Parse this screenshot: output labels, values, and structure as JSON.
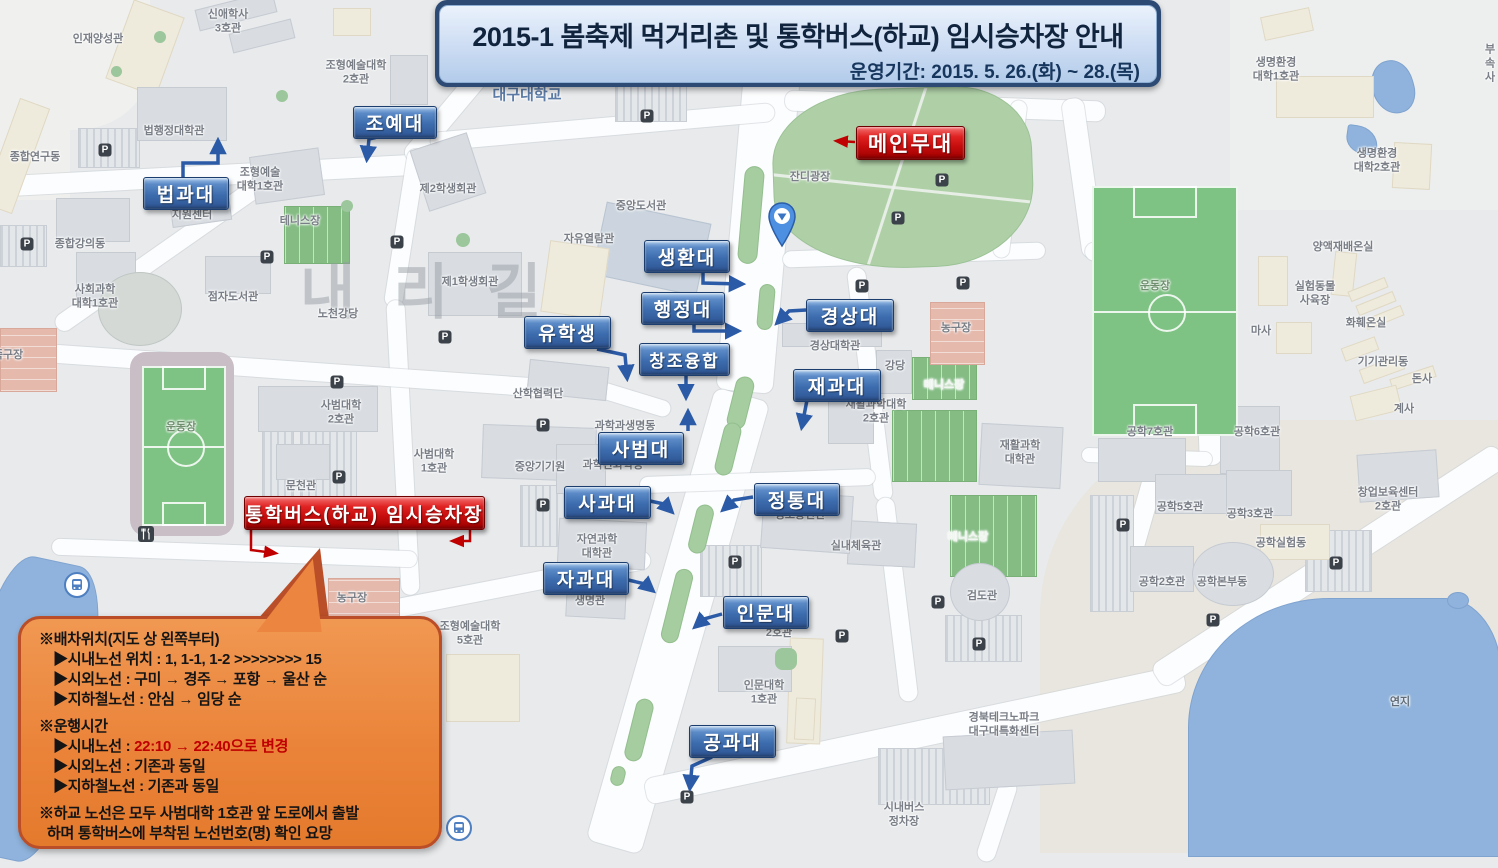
{
  "banner": {
    "title": "2015-1 봄축제 먹거리촌 및 통학버스(하교) 임시승차장 안내",
    "subtitle": "운영기간: 2015. 5. 26.(화) ~ 28.(목)"
  },
  "watermark": {
    "text": "내리길"
  },
  "icons": {
    "parking_glyph": "P"
  },
  "colors": {
    "label_blue": "#3D6CAE",
    "label_red": "#C60D0D",
    "bubble_orange": "#EA8238",
    "highlight_red": "#C00000"
  },
  "map_labels": [
    {
      "t": "인재양성관",
      "x": 98,
      "y": 40
    },
    {
      "t": "신애학사\n3호관",
      "x": 228,
      "y": 22
    },
    {
      "t": "조형예술대학\n2호관",
      "x": 356,
      "y": 73
    },
    {
      "t": "대구대학교",
      "x": 527,
      "y": 96,
      "fs": 15,
      "c": "#5C7CA8",
      "b": true
    },
    {
      "t": "법행정대학관",
      "x": 174,
      "y": 132
    },
    {
      "t": "종합연구동",
      "x": 35,
      "y": 158
    },
    {
      "t": "조형예술\n대학1호관",
      "x": 260,
      "y": 180
    },
    {
      "t": "지원센터",
      "x": 192,
      "y": 216
    },
    {
      "t": "테니스장",
      "x": 300,
      "y": 222
    },
    {
      "t": "제2학생회관",
      "x": 448,
      "y": 190
    },
    {
      "t": "중앙도서관",
      "x": 641,
      "y": 207
    },
    {
      "t": "자유열람관",
      "x": 589,
      "y": 240
    },
    {
      "t": "잔디광장",
      "x": 810,
      "y": 178
    },
    {
      "t": "제1학생회관",
      "x": 470,
      "y": 283
    },
    {
      "t": "노천강당",
      "x": 338,
      "y": 315
    },
    {
      "t": "종합강의동",
      "x": 80,
      "y": 245
    },
    {
      "t": "사회과학\n대학1호관",
      "x": 95,
      "y": 297
    },
    {
      "t": "점자도서관",
      "x": 233,
      "y": 298
    },
    {
      "t": "산학협력단",
      "x": 538,
      "y": 395
    },
    {
      "t": "경상대학관",
      "x": 835,
      "y": 347
    },
    {
      "t": "강당",
      "x": 895,
      "y": 367
    },
    {
      "t": "테니스장",
      "x": 944,
      "y": 386,
      "c": "#F2F6F2"
    },
    {
      "t": "테니스장",
      "x": 968,
      "y": 538,
      "c": "#F2F6F2"
    },
    {
      "t": "재활과학대학\n2호관",
      "x": 876,
      "y": 412
    },
    {
      "t": "재활과학\n대학관",
      "x": 1020,
      "y": 453
    },
    {
      "t": "농구장",
      "x": 956,
      "y": 329
    },
    {
      "t": "정보통신관",
      "x": 800,
      "y": 516
    },
    {
      "t": "실내체육관",
      "x": 856,
      "y": 547
    },
    {
      "t": "검도관",
      "x": 982,
      "y": 597
    },
    {
      "t": "과학과생명동",
      "x": 625,
      "y": 427
    },
    {
      "t": "과학관화학동",
      "x": 613,
      "y": 466
    },
    {
      "t": "중앙기기원",
      "x": 540,
      "y": 468
    },
    {
      "t": "사범대학\n2호관",
      "x": 341,
      "y": 413
    },
    {
      "t": "사범대학\n1호관",
      "x": 434,
      "y": 462
    },
    {
      "t": "문천관",
      "x": 301,
      "y": 487
    },
    {
      "t": "자연과학\n대학관",
      "x": 597,
      "y": 547
    },
    {
      "t": "생명관",
      "x": 590,
      "y": 602
    },
    {
      "t": "조형예술대학\n5호관",
      "x": 470,
      "y": 634
    },
    {
      "t": "농구장",
      "x": 352,
      "y": 599
    },
    {
      "t": "족구장",
      "x": 8,
      "y": 356
    },
    {
      "t": "운동장",
      "x": 181,
      "y": 428,
      "c": "#6F8F6F"
    },
    {
      "t": "운동장",
      "x": 1155,
      "y": 287,
      "c": "#6F8F6F"
    },
    {
      "t": "인문대학\n1호관",
      "x": 764,
      "y": 693
    },
    {
      "t": "2호관",
      "x": 779,
      "y": 634
    },
    {
      "t": "경북테크노파크\n대구대특화센터",
      "x": 1004,
      "y": 725
    },
    {
      "t": "시내버스\n정차장",
      "x": 904,
      "y": 815
    },
    {
      "t": "연지",
      "x": 1400,
      "y": 703,
      "c": "#5F6B78"
    },
    {
      "t": "생명환경\n대학1호관",
      "x": 1276,
      "y": 70
    },
    {
      "t": "생명환경\n대학2호관",
      "x": 1377,
      "y": 161
    },
    {
      "t": "부속\n사",
      "x": 1490,
      "y": 64
    },
    {
      "t": "양액재배온실",
      "x": 1343,
      "y": 248
    },
    {
      "t": "실험동물\n사육장",
      "x": 1315,
      "y": 294
    },
    {
      "t": "마사",
      "x": 1261,
      "y": 332
    },
    {
      "t": "화훼온실",
      "x": 1366,
      "y": 324
    },
    {
      "t": "기기관리동",
      "x": 1383,
      "y": 363
    },
    {
      "t": "돈사",
      "x": 1422,
      "y": 380
    },
    {
      "t": "계사",
      "x": 1404,
      "y": 410
    },
    {
      "t": "공학7호관",
      "x": 1150,
      "y": 433
    },
    {
      "t": "공학6호관",
      "x": 1257,
      "y": 433
    },
    {
      "t": "공학5호관",
      "x": 1180,
      "y": 508
    },
    {
      "t": "공학3호관",
      "x": 1250,
      "y": 515
    },
    {
      "t": "창업보육센터\n2호관",
      "x": 1388,
      "y": 500
    },
    {
      "t": "공학실험동",
      "x": 1281,
      "y": 544
    },
    {
      "t": "공학2호관",
      "x": 1162,
      "y": 583
    },
    {
      "t": "공학본부동",
      "x": 1222,
      "y": 583
    }
  ],
  "parking_icons": [
    [
      105,
      150
    ],
    [
      27,
      244
    ],
    [
      267,
      257
    ],
    [
      397,
      242
    ],
    [
      445,
      337
    ],
    [
      337,
      382
    ],
    [
      339,
      477
    ],
    [
      543,
      425
    ],
    [
      543,
      505
    ],
    [
      647,
      116
    ],
    [
      942,
      180
    ],
    [
      898,
      218
    ],
    [
      862,
      286
    ],
    [
      963,
      283
    ],
    [
      1123,
      525
    ],
    [
      1336,
      563
    ],
    [
      1213,
      620
    ],
    [
      687,
      797
    ],
    [
      842,
      636
    ],
    [
      979,
      644
    ],
    [
      735,
      562
    ],
    [
      938,
      602
    ]
  ],
  "blue_labels": [
    {
      "t": "조예대",
      "x": 353,
      "y": 106,
      "w": 82
    },
    {
      "t": "법과대",
      "x": 143,
      "y": 177,
      "w": 84
    },
    {
      "t": "생환대",
      "x": 644,
      "y": 240,
      "w": 84
    },
    {
      "t": "행정대",
      "x": 641,
      "y": 292,
      "w": 82
    },
    {
      "t": "유학생",
      "x": 524,
      "y": 316,
      "w": 85
    },
    {
      "t": "창조융합",
      "x": 639,
      "y": 343,
      "w": 89,
      "fs": 17
    },
    {
      "t": "경상대",
      "x": 806,
      "y": 299,
      "w": 86
    },
    {
      "t": "재과대",
      "x": 793,
      "y": 369,
      "w": 86
    },
    {
      "t": "사범대",
      "x": 598,
      "y": 432,
      "w": 84
    },
    {
      "t": "사과대",
      "x": 564,
      "y": 486,
      "w": 85
    },
    {
      "t": "정통대",
      "x": 754,
      "y": 483,
      "w": 84
    },
    {
      "t": "자과대",
      "x": 543,
      "y": 562,
      "w": 84
    },
    {
      "t": "인문대",
      "x": 723,
      "y": 596,
      "w": 84
    },
    {
      "t": "공과대",
      "x": 689,
      "y": 725,
      "w": 85
    }
  ],
  "red_labels": [
    {
      "t": "메인무대",
      "x": 856,
      "y": 126,
      "w": 107,
      "fs": 21
    },
    {
      "t": "통학버스(하교) 임시승차장",
      "x": 244,
      "y": 496,
      "w": 239,
      "fs": 19
    }
  ],
  "arrows": [
    {
      "c": "blue",
      "pts": [
        [
          386,
          135
        ],
        [
          369,
          139
        ],
        [
          367,
          158
        ]
      ]
    },
    {
      "c": "blue",
      "pts": [
        [
          183,
          177
        ],
        [
          183,
          163
        ],
        [
          218,
          163
        ],
        [
          218,
          142
        ]
      ]
    },
    {
      "c": "blue",
      "pts": [
        [
          703,
          273
        ],
        [
          703,
          283
        ],
        [
          741,
          284
        ]
      ]
    },
    {
      "c": "blue",
      "pts": [
        [
          694,
          324
        ],
        [
          694,
          331
        ],
        [
          737,
          331
        ]
      ]
    },
    {
      "c": "blue",
      "pts": [
        [
          597,
          349
        ],
        [
          625,
          355
        ],
        [
          627,
          377
        ]
      ]
    },
    {
      "c": "blue",
      "pts": [
        [
          686,
          375
        ],
        [
          686,
          396
        ]
      ]
    },
    {
      "c": "blue",
      "pts": [
        [
          806,
          310
        ],
        [
          789,
          311
        ],
        [
          778,
          322
        ]
      ]
    },
    {
      "c": "blue",
      "pts": [
        [
          807,
          400
        ],
        [
          802,
          426
        ]
      ]
    },
    {
      "c": "blue",
      "pts": [
        [
          688,
          431
        ],
        [
          688,
          413
        ]
      ]
    },
    {
      "c": "blue",
      "pts": [
        [
          650,
          501
        ],
        [
          664,
          504
        ],
        [
          671,
          511
        ]
      ]
    },
    {
      "c": "blue",
      "pts": [
        [
          753,
          497
        ],
        [
          734,
          500
        ],
        [
          724,
          509
        ]
      ]
    },
    {
      "c": "blue",
      "pts": [
        [
          624,
          579
        ],
        [
          645,
          584
        ],
        [
          652,
          590
        ]
      ]
    },
    {
      "c": "blue",
      "pts": [
        [
          722,
          614
        ],
        [
          704,
          619
        ],
        [
          696,
          626
        ]
      ]
    },
    {
      "c": "blue",
      "pts": [
        [
          712,
          757
        ],
        [
          692,
          766
        ],
        [
          690,
          787
        ]
      ]
    },
    {
      "c": "red",
      "pts": [
        [
          855,
          142
        ],
        [
          838,
          141
        ]
      ]
    },
    {
      "c": "red",
      "pts": [
        [
          251,
          529
        ],
        [
          251,
          550
        ],
        [
          274,
          553
        ]
      ]
    },
    {
      "c": "red",
      "pts": [
        [
          470,
          529
        ],
        [
          470,
          541
        ],
        [
          454,
          541
        ]
      ]
    }
  ],
  "bubble": {
    "lines": [
      {
        "indent": 0,
        "segs": [
          {
            "t": "※배차위치(지도 상 왼쪽부터)"
          }
        ]
      },
      {
        "indent": 1,
        "segs": [
          {
            "t": "▶시내노선 위치 : 1, 1-1, 1-2 >>>>>>>> 15"
          }
        ]
      },
      {
        "indent": 1,
        "segs": [
          {
            "t": "▶시외노선 : 구미 → 경주 → 포항 → 울산 순"
          }
        ]
      },
      {
        "indent": 1,
        "segs": [
          {
            "t": "▶지하철노선 : 안심 → 임당 순"
          }
        ]
      },
      {
        "indent": 0,
        "gap": true,
        "segs": [
          {
            "t": "※운행시간"
          }
        ]
      },
      {
        "indent": 1,
        "segs": [
          {
            "t": "▶시내노선 : "
          },
          {
            "t": "22:10 → 22:40으로 변경",
            "red": true
          }
        ]
      },
      {
        "indent": 1,
        "segs": [
          {
            "t": "▶시외노선 : 기존과 동일"
          }
        ]
      },
      {
        "indent": 1,
        "segs": [
          {
            "t": "▶지하철노선 : 기존과 동일"
          }
        ]
      },
      {
        "indent": 0,
        "gap": true,
        "segs": [
          {
            "t": "※하교 노선은 모두 사범대학 1호관 앞 도로에서 출발"
          }
        ]
      },
      {
        "indent": 0,
        "cont": true,
        "segs": [
          {
            "t": "하며 통학버스에 부착된 노선번호(명) 확인 요망"
          }
        ]
      }
    ]
  }
}
